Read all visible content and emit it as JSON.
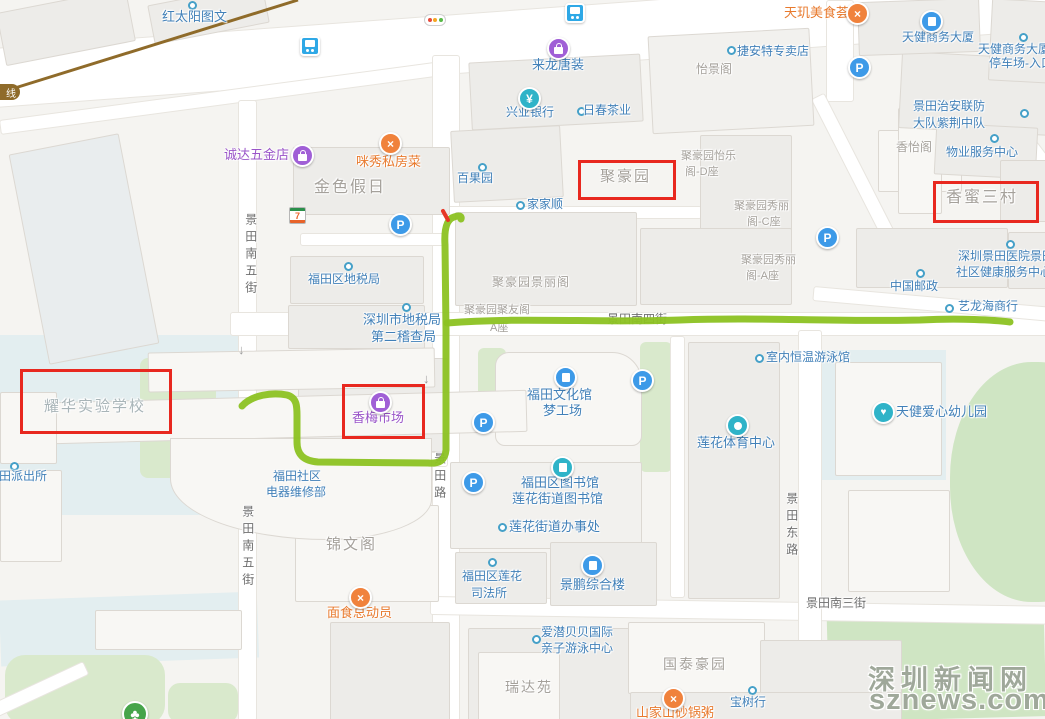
{
  "labels": {
    "hongtaiyang": "红太阳图文",
    "lailong": "来龙唐装",
    "jieante": "捷安特专卖店",
    "yijingge": "怡景阁",
    "tianji": "天玑美食荟",
    "tianjian_tower": "天健商务大厦",
    "tj_parking1": "天健商务大厦",
    "tj_parking2": "停车场-入口",
    "zhian1": "景田治安联防",
    "zhian2": "大队紫荆中队",
    "xiangyige": "香怡阁",
    "wuye": "物业服务中心",
    "xingye": "兴业银行",
    "richun": "日春茶业",
    "chengda": "诚达五金店",
    "mixiu": "咪秀私房菜",
    "jinse": "金色假日",
    "baiguoyuan": "百果园",
    "juhaoyuan": "聚豪园",
    "jiajiashun": "家家顺",
    "yile1": "聚豪园怡乐",
    "yile2": "阁-D座",
    "xiangmi": "香蜜三村",
    "xiuli_c1": "聚豪园秀丽",
    "xiuli_c2": "阁-C座",
    "futian_tax": "福田区地税局",
    "jingli": "聚豪园景丽阁",
    "xiuli_a1": "聚豪园秀丽",
    "xiuli_a2": "阁-A座",
    "hospital1": "深圳景田医院景田",
    "hospital2": "社区健康服务中心",
    "youzheng": "中国邮政",
    "sz_tax1": "深圳市地税局",
    "sz_tax2": "第二稽查局",
    "juyou1": "聚豪园聚友阁",
    "juyou2": "A座",
    "yilonghai": "艺龙海商行",
    "yaohua": "耀华实验学校",
    "xiangmei": "香梅市场",
    "wenhua1": "福田文化馆",
    "wenhua2": "梦工场",
    "yongyong": "室内恒温游泳馆",
    "lianhua_sports": "莲花体育中心",
    "tj_kids": "天健爱心幼儿园",
    "shequ1": "福田社区",
    "shequ2": "电器维修部",
    "library1": "福田区图书馆",
    "library2": "莲花街道图书馆",
    "jiedao": "莲花街道办事处",
    "jinwenge": "锦文阁",
    "sifa1": "福田区莲花",
    "sifa2": "司法所",
    "jingpeng": "景鹏综合楼",
    "mianshi": "面食总动员",
    "aiqian1": "爱潜贝贝国际",
    "aiqian2": "亲子游泳中心",
    "guotai": "国泰豪园",
    "ruidayuan": "瑞达苑",
    "baoshuhang": "宝树行",
    "shanjiashan": "山家山砂锅粥",
    "paichusuo": "景田派出所",
    "st_jtn5": "景田南五街",
    "st_jtlu": "景田路",
    "st_jtdong": "景田东路",
    "st_jtn3": "景田南三街",
    "st_jtn4": "景田南四街"
  },
  "icons": {
    "parking": "P",
    "bank": "¥",
    "seven": "7",
    "rail_line": "线",
    "restaurant": "×",
    "kids": "♥",
    "tree": "♣",
    "down_arrow": "↓"
  },
  "annotation": {
    "highlight_color": "#e8281f",
    "route_color": "#8cc222"
  },
  "watermark": {
    "line1": "深圳新闻网",
    "line2": "sznews.com"
  }
}
